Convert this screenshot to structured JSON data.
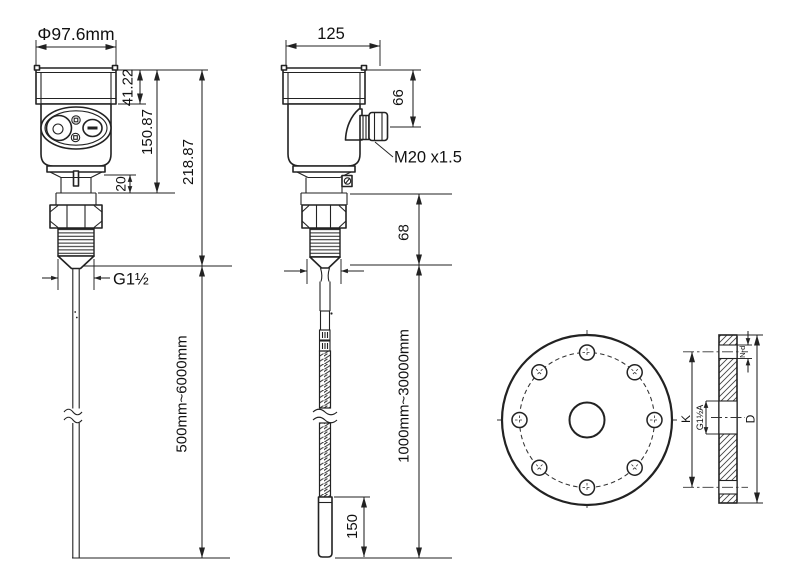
{
  "colors": {
    "line": "#222222",
    "text": "#111111",
    "background": "#ffffff"
  },
  "views": {
    "rod_version": {
      "head_diameter": "Φ97.6mm",
      "cap_height": "41.22",
      "head_height": "150.87",
      "mount_bottom_height": "218.87",
      "neck_height": "20",
      "process_thread": "G1½",
      "probe_length_range": "500mm~6000mm"
    },
    "cable_version": {
      "head_width": "125",
      "gland_offset": "66",
      "gland_thread": "M20 x1.5",
      "mount_section_height": "68",
      "cable_length_range": "1000mm~30000mm",
      "weight_length": "150"
    },
    "flange": {
      "bolt_circle_diameter": "K",
      "center_thread": "G1½A",
      "outer_diameter": "D",
      "bolt_holes": "N-d"
    }
  }
}
